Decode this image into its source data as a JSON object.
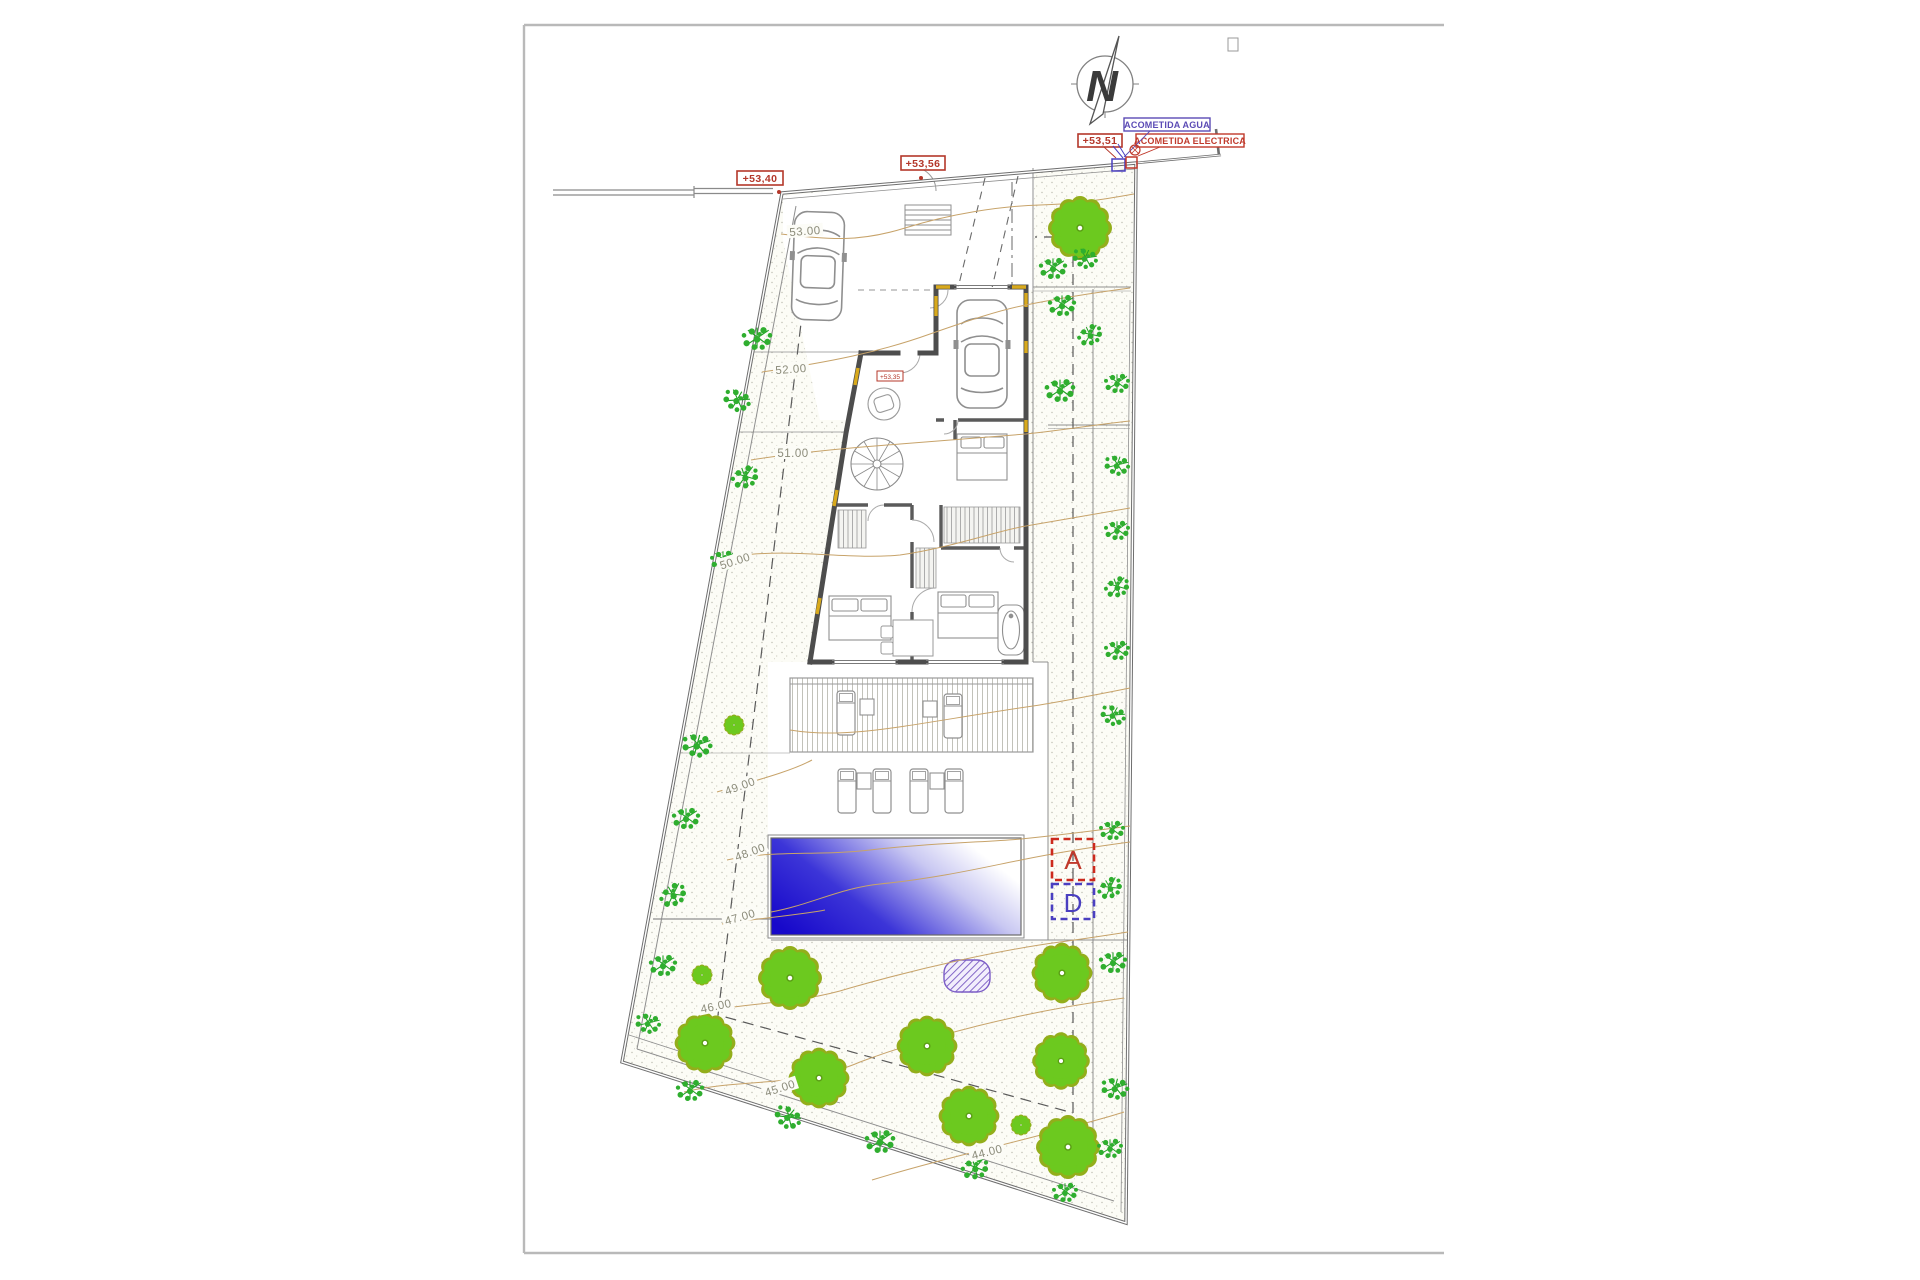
{
  "compass": {
    "label": "N"
  },
  "levels": {
    "street_left": "+53,40",
    "street_mid": "+53,56",
    "street_right": "+53,51",
    "floor_tag": "+53,35"
  },
  "utilities": {
    "water": "ACOMETIDA AGUA",
    "electric": "ACOMETIDA ELECTRICA"
  },
  "contours": [
    "53.00",
    "52.00",
    "51.00",
    "50.00",
    "49.00",
    "48.00",
    "47.00",
    "46.00",
    "45.00",
    "44.00"
  ],
  "sections": {
    "a": "A",
    "d": "D"
  },
  "colors": {
    "marker_red": "#c0392b",
    "marker_blue": "#4a3fc0",
    "utility_purple": "#5b4bb5",
    "pool_deep_blue": "#1708ca",
    "tree_green": "#6cc91f",
    "tree_olive": "#93ae1b",
    "shrub_green": "#229a27",
    "contour_tan": "#c7a36a",
    "wall_gray": "#4d4d4d",
    "insulation_yellow": "#d8a91c"
  }
}
